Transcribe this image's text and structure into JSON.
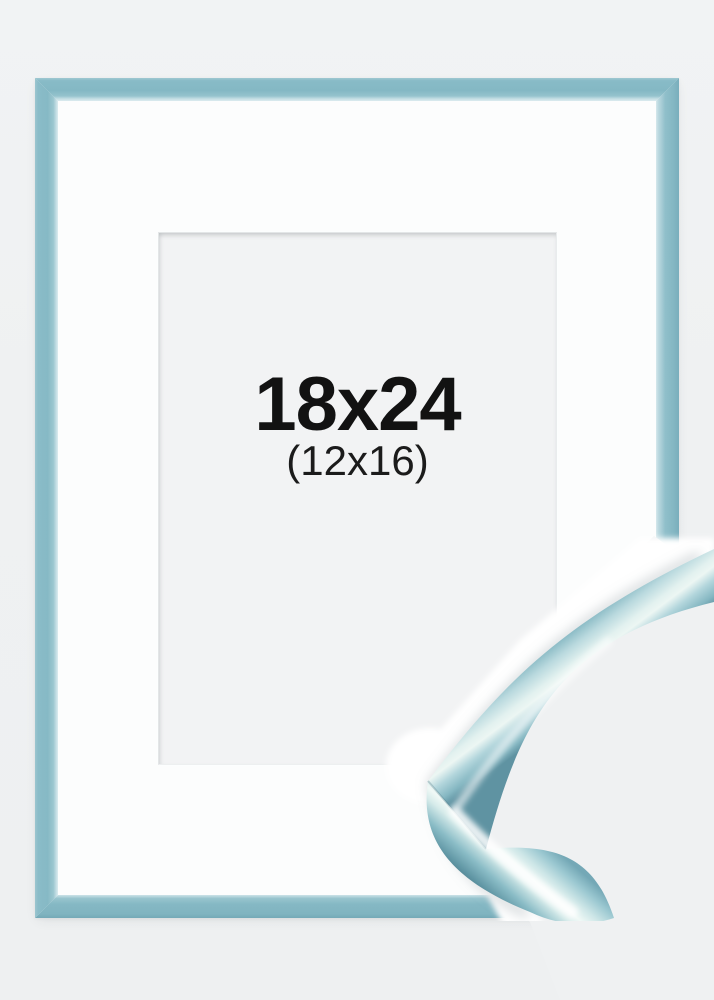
{
  "product": {
    "size_label": "18x24",
    "inner_size_label": "(12x16)"
  },
  "colors": {
    "background": "#eff1f2",
    "frame-blue": "#87bac6",
    "frame-blue-light": "#cfe4e9",
    "frame-blue-dark": "#6ea7b5",
    "mat-white": "#fcfdfd",
    "opening-gray": "#f2f3f4",
    "label-text": "#121212"
  }
}
